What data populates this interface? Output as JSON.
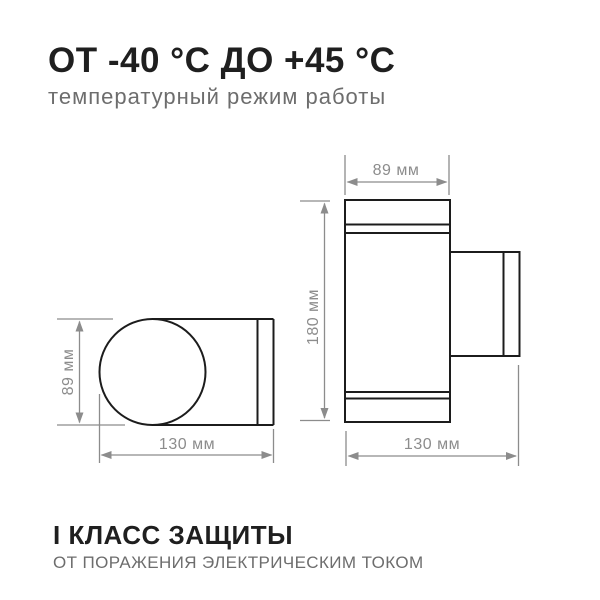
{
  "colors": {
    "background": "#ffffff",
    "drawing-line": "#1c1c1c",
    "dimension-line": "#8c8c8c",
    "title-text": "#1f1f1f",
    "subtitle-text": "#6d6d6d"
  },
  "header": {
    "title": "ОТ -40 °С ДО +45 °С",
    "subtitle": "температурный режим работы"
  },
  "diagram": {
    "side_view": {
      "height_label": "89 мм",
      "width_label": "130 мм"
    },
    "front_view": {
      "width_label": "89 мм",
      "height_label": "180 мм",
      "depth_label": "130 мм"
    }
  },
  "footer": {
    "title": "I КЛАСС ЗАЩИТЫ",
    "subtitle": "ОТ ПОРАЖЕНИЯ ЭЛЕКТРИЧЕСКИМ ТОКОМ"
  }
}
